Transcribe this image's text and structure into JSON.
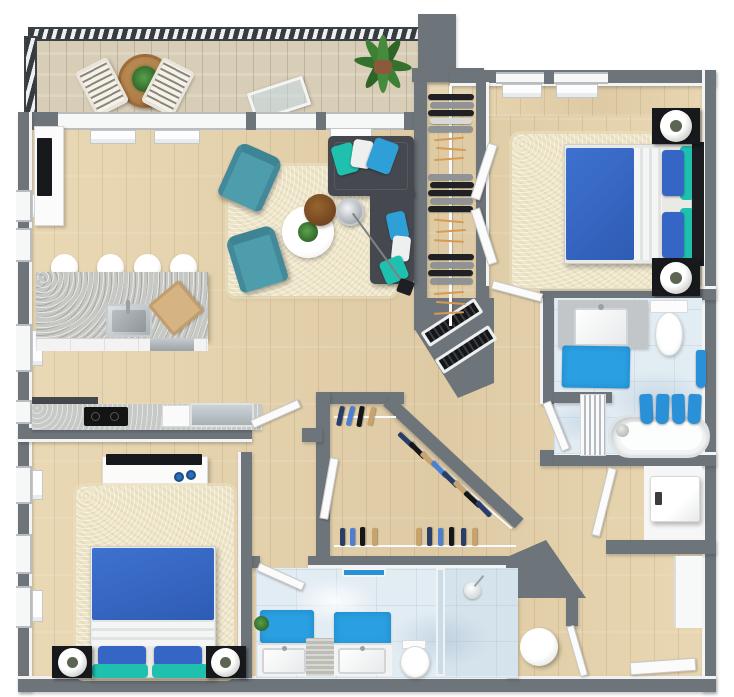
{
  "meta": {
    "kind": "3d-floor-plan-render",
    "view": "top-down",
    "unit": "two-bedroom two-bath apartment with balcony",
    "canvas": {
      "width": 734,
      "height": 697
    }
  },
  "palette": {
    "wall": "#6d747a",
    "wood": "#e7d3ab",
    "balcony-wood": "#d8cdb7",
    "marble": "#e2ecf3",
    "rug": "#efe6ca",
    "sofa": "#45494f",
    "armchair": "#4e9dad",
    "bed-blue": "#3566c6",
    "teal": "#1fc0ae",
    "mat-blue": "#2aa0e2",
    "towel-blue": "#2a90d8",
    "island": "#c7c8c3",
    "counter": "#c6c9c6",
    "stainless": "#b6bdc1",
    "cooktop": "#141414",
    "tv-black": "#17191c",
    "cutting-board": "#d6b383",
    "table-brown": "#b5854f",
    "side-table-brown": "#7d4f28",
    "plant-green": "#3a7a31",
    "hanger": "#d89a52",
    "decor-blue": "#2a6fb8"
  },
  "rooms": [
    {
      "name": "balcony",
      "features": [
        "metal-railing",
        "wood-deck"
      ],
      "furniture": [
        "round-patio-table",
        "table-plant",
        "striped-patio-chair",
        "striped-patio-chair",
        "potted-palm",
        "open-glass-door"
      ]
    },
    {
      "name": "living-room",
      "furniture": [
        "l-shaped-sectional-sofa",
        "throw-pillows x6",
        "shag-area-rug",
        "round-coffee-table-with-plant",
        "round-side-table",
        "arc-floor-lamp",
        "accent-armchair",
        "accent-armchair",
        "media-cabinet",
        "wall-tv"
      ]
    },
    {
      "name": "kitchen",
      "furniture": [
        "island-with-sink",
        "bar-stool x4",
        "cutting-board",
        "dishwasher",
        "wall-counter-with-cooktop",
        "stainless-counter-section"
      ]
    },
    {
      "name": "bedroom-1",
      "furniture": [
        "double-bed-blue",
        "pillows-blue-teal",
        "nightstand x2",
        "sphere-table-lamp x2",
        "shag-area-rug",
        "window x2",
        "double-closet-doors"
      ]
    },
    {
      "name": "walk-in-closet-1",
      "furniture": [
        "center-hanging-rail",
        "hanging-clothes",
        "wood-hangers"
      ]
    },
    {
      "name": "bathroom-1",
      "furniture": [
        "vanity-with-sink",
        "toilet",
        "bath-mat",
        "bathtub",
        "towel-rack-towels x4",
        "shower-curtain",
        "wall-towel"
      ]
    },
    {
      "name": "hallway",
      "furniture": []
    },
    {
      "name": "utility-closet",
      "furniture": [
        "louvered-stacked-appliance"
      ]
    },
    {
      "name": "walk-in-closet-2",
      "furniture": [
        "hanging-rail x3",
        "hanging-clothes"
      ]
    },
    {
      "name": "bedroom-2",
      "furniture": [
        "double-bed-blue",
        "pillows-blue-teal",
        "nightstand x2",
        "sphere-table-lamp x2",
        "shag-area-rug",
        "dresser",
        "tv",
        "decor-vase x2",
        "window x3"
      ]
    },
    {
      "name": "bathroom-2",
      "furniture": [
        "double-vanity",
        "sink x2",
        "bath-mat x2",
        "laundry-basket",
        "toilet",
        "walk-in-shower",
        "shower-head",
        "towel-bar",
        "small-plant"
      ]
    },
    {
      "name": "water-closet",
      "furniture": [
        "round-tank"
      ]
    },
    {
      "name": "laundry-closet",
      "furniture": [
        "washer"
      ]
    },
    {
      "name": "entry",
      "furniture": [
        "entry-door",
        "wall-niche"
      ]
    }
  ]
}
